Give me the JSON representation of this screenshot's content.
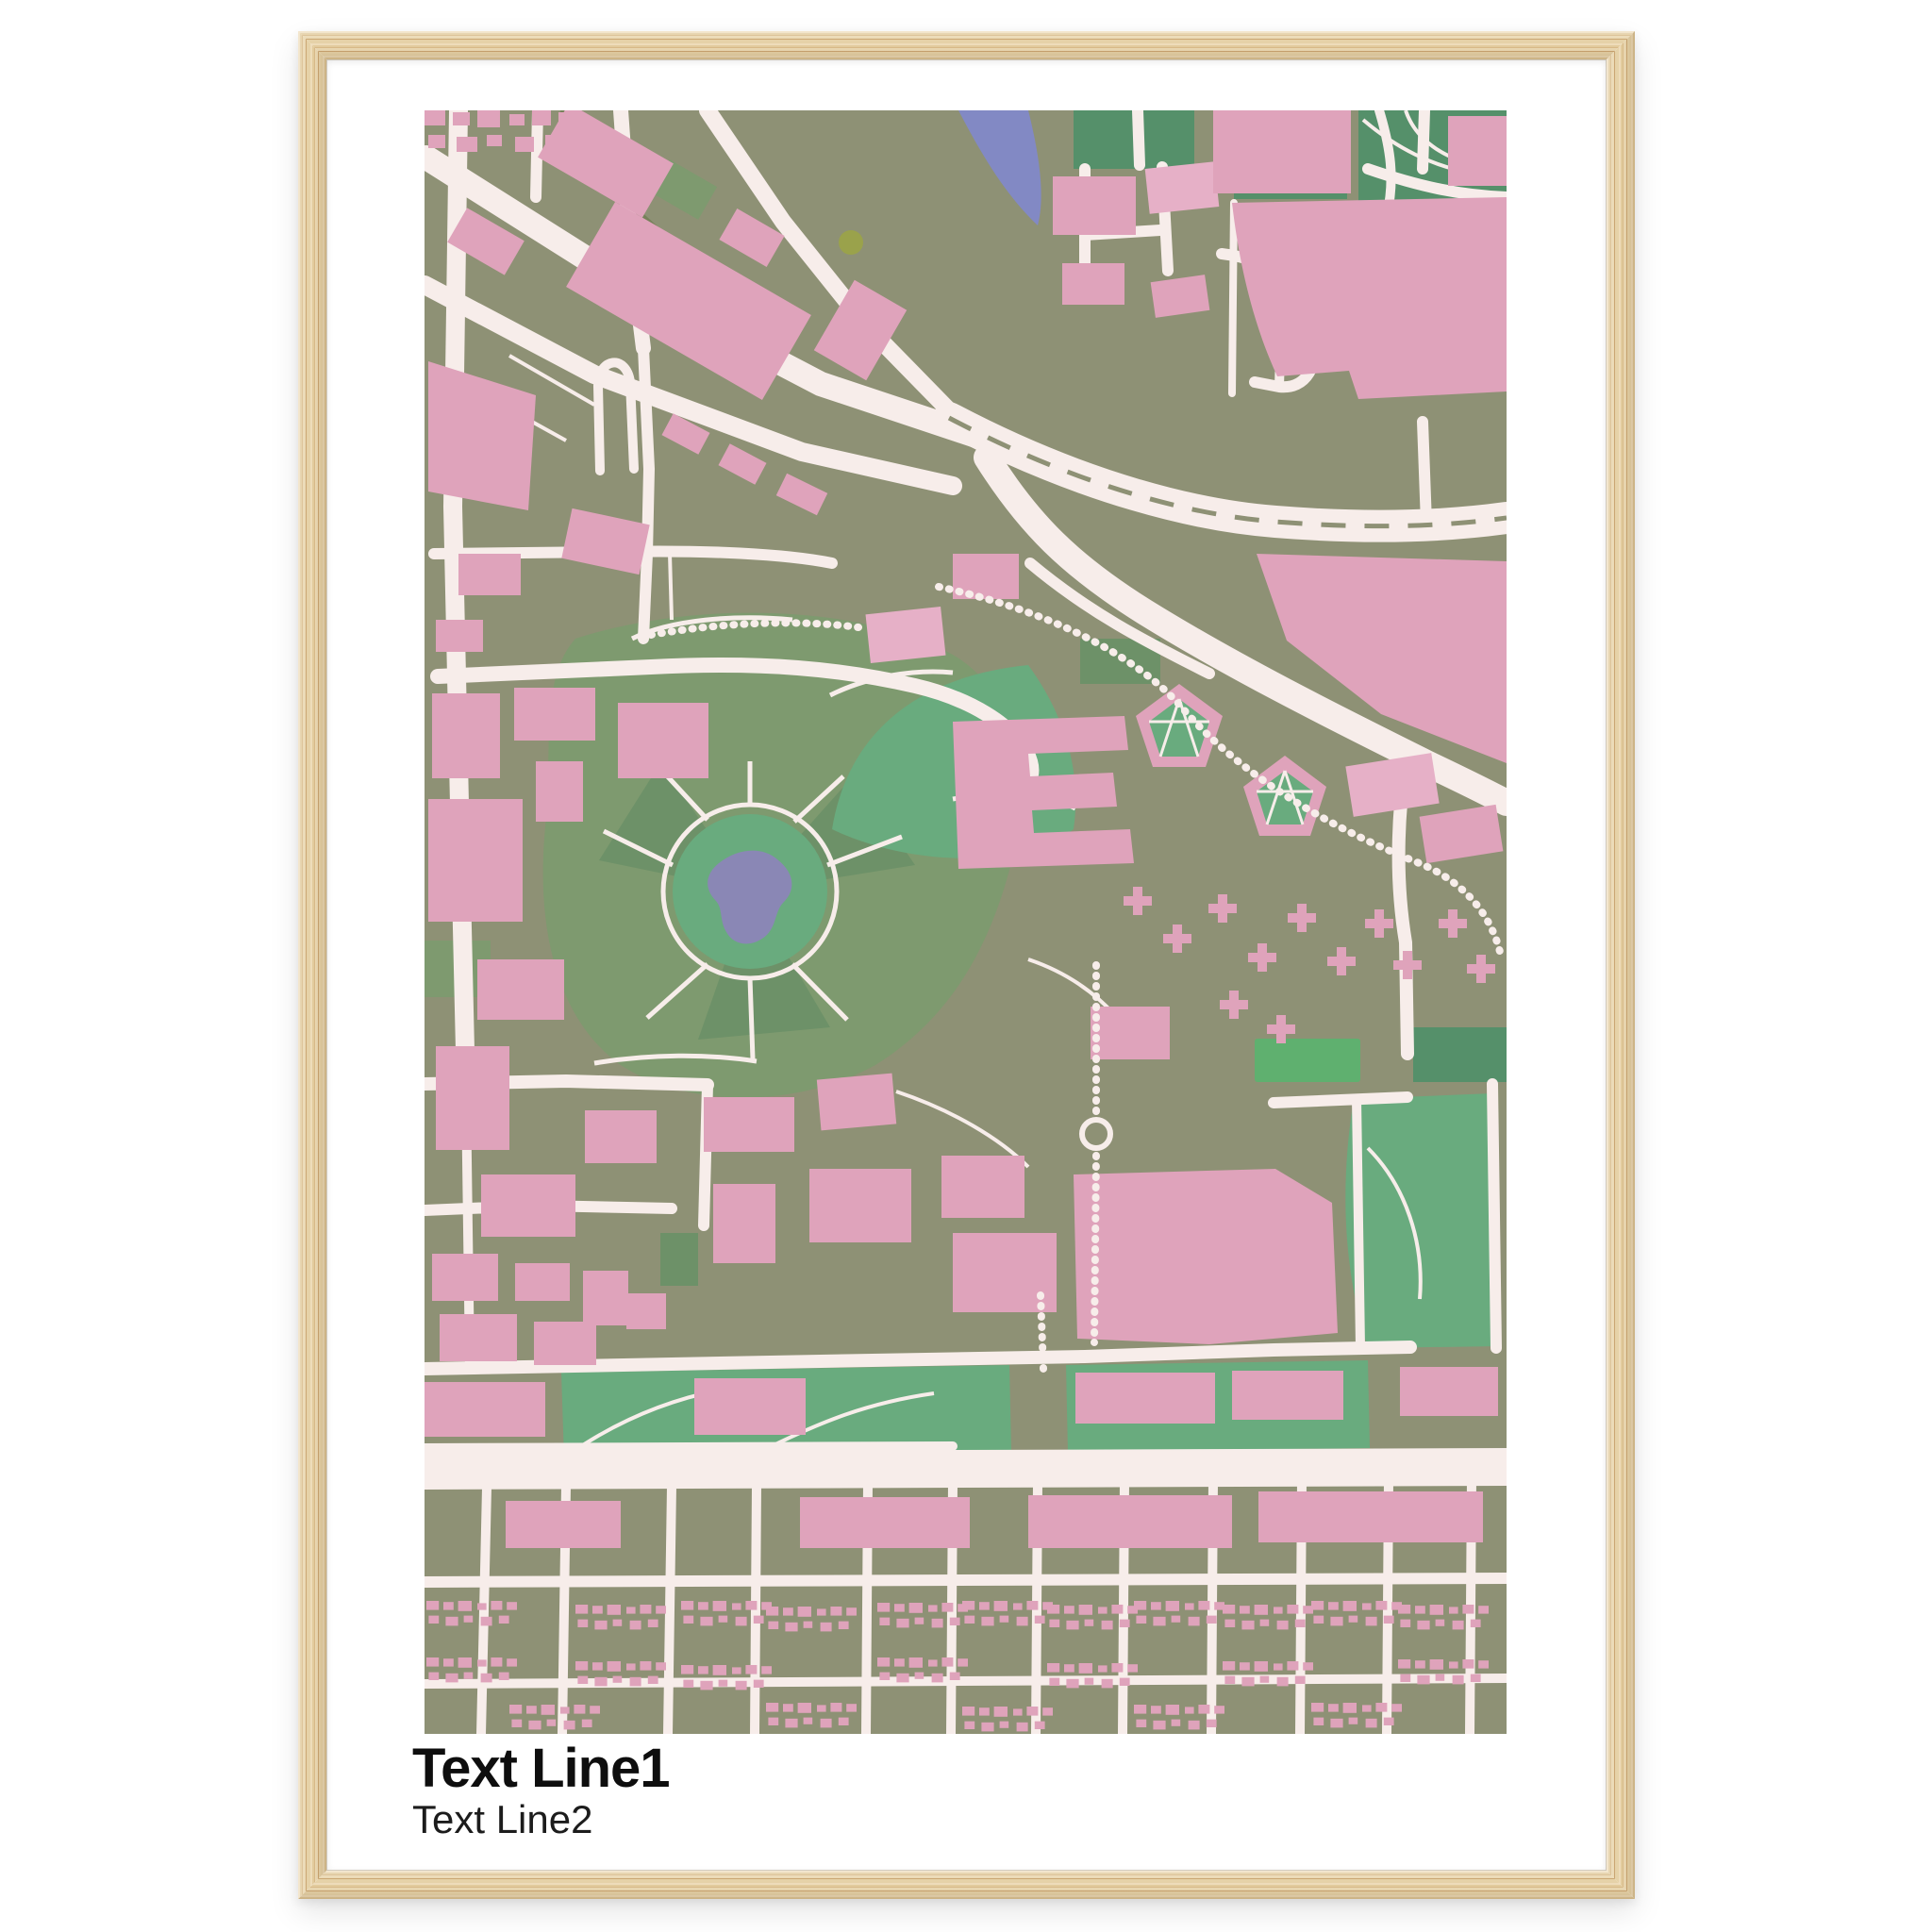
{
  "poster": {
    "text_line_1": "Text Line1",
    "text_line_2": "Text Line2"
  },
  "colors": {
    "page_background": "#ffffff",
    "mat": "#ffffff",
    "frame_wood_light": "#eedcba",
    "frame_wood_mid": "#dcc190",
    "frame_wood_dark": "#c9a471",
    "map_background": "#8e9175",
    "building": "#dfa3bb",
    "building_light": "#e6b0c7",
    "road": "#f7edea",
    "park_muted": "#7e9a6f",
    "park_dark": "#6d9168",
    "park_bright": "#69ab7e",
    "forest": "#55906a",
    "field_green": "#5fb06f",
    "water": "#8289c4",
    "pond": "#8a87b5",
    "path_dark": "#77815a",
    "text_primary": "#0e0e0e",
    "text_secondary": "#1c1c1c"
  }
}
